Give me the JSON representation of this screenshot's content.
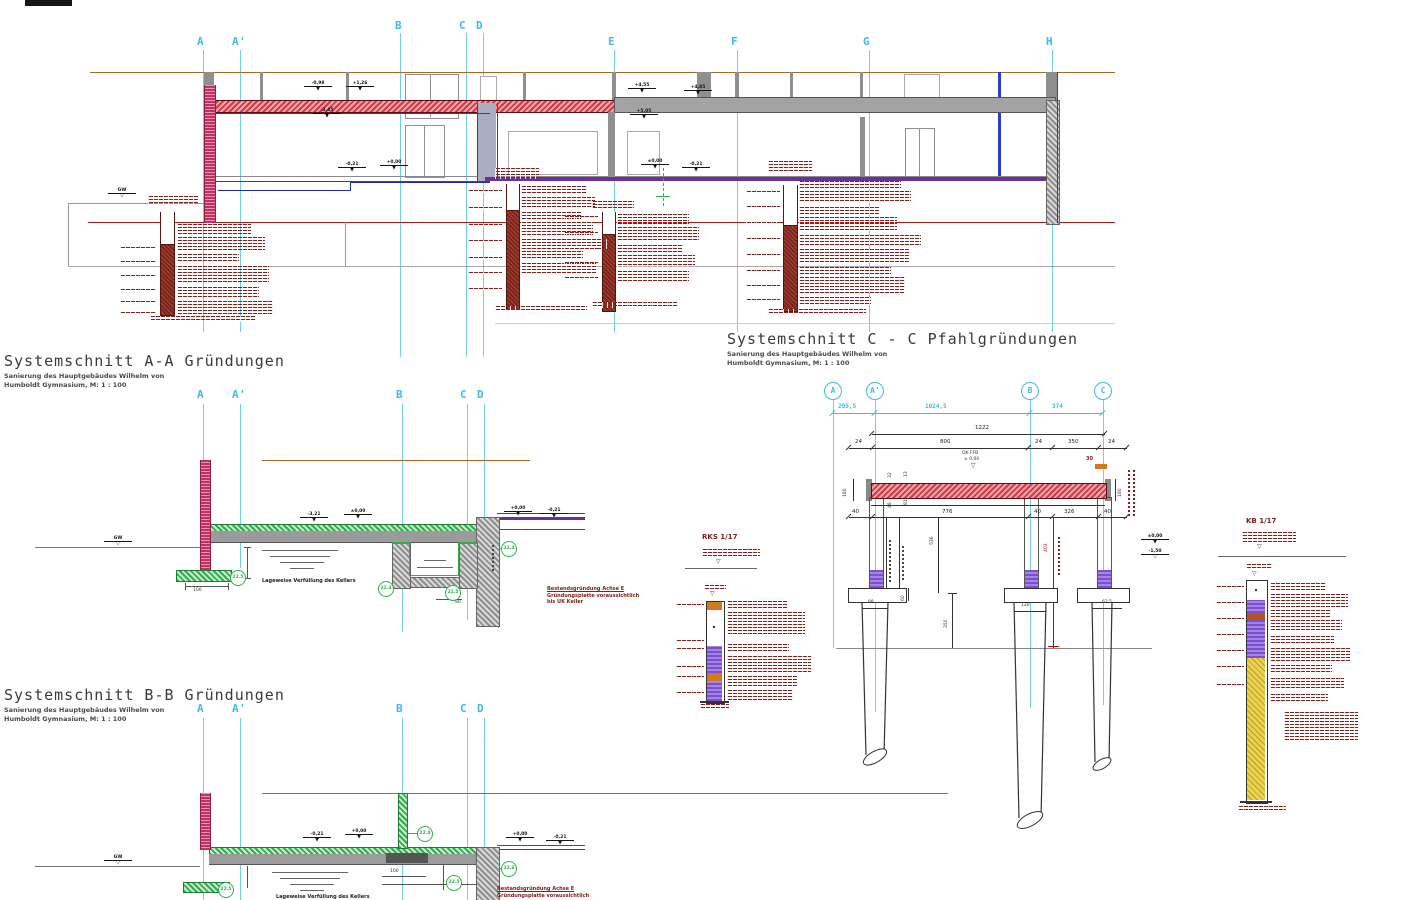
{
  "drawing": {
    "grid_top": [
      "A",
      "A'",
      "B",
      "C",
      "D",
      "E",
      "F",
      "G",
      "H"
    ],
    "grid_section": [
      "A",
      "A'",
      "B",
      "C",
      "D"
    ],
    "pile_axes": [
      "A",
      "A'",
      "B",
      "C"
    ],
    "titles": {
      "a_title": "Systemschnitt A-A Gründungen",
      "b_title": "Systemschnitt B-B Gründungen",
      "c_title": "Systemschnitt C - C Pfahlgründungen",
      "sub1": "Sanierung des Hauptgebäudes Wilhelm von",
      "sub2": "Humboldt Gymnasium, M: 1 : 100"
    },
    "levels_top": [
      "-0,98",
      "+1,26",
      "-3,45",
      "+4,55",
      "+4,85",
      "+5,05",
      "-0,21",
      "+0,00",
      "±0,00",
      "-0,21",
      "GW"
    ],
    "levels_a": [
      "-3,21",
      "±0,00",
      "+0,00",
      "-0,21",
      "GW"
    ],
    "levels_b": [
      "-0,21",
      "+0,00",
      "+0,00",
      "-0,21",
      "GW"
    ],
    "levels_c": [
      "±0,00",
      "-1,50"
    ],
    "ok_ffb": {
      "l1": "OK FFB",
      "l2": "± 0,00"
    },
    "dims": {
      "cyan": [
        "205,5",
        "1024,5",
        "374"
      ],
      "total": "1222",
      "row2": [
        "24",
        "800",
        "24",
        "350",
        "24"
      ],
      "row3": [
        "40",
        "776",
        "40",
        "326",
        "40"
      ],
      "v_180l": "180",
      "v_180r": "180",
      "v_32": "32",
      "v_13": "13",
      "v_48": "48",
      "v_81": "81",
      "v_536": "536",
      "v_403": "403",
      "v_350": "350",
      "v_60": "60",
      "d_30": "30",
      "caps": [
        "88",
        "120",
        "62,5"
      ]
    },
    "circles_a": [
      "22.5",
      "22.4",
      "22.5",
      "22.4"
    ],
    "circles_b": [
      "22.5",
      "22.4",
      "22.5",
      "22.6"
    ],
    "notes": {
      "verfuellung": "Lageweise Verfüllung des Kellers",
      "bestand1": "Bestandsgründung Achse E",
      "bestand2": "Gründungsplatte voraussichtlich",
      "bestand3": "bis UK Keller",
      "dim100": "100",
      "dim80": "80"
    },
    "logs": {
      "rks": "RKS 1/17",
      "kb": "KB 1/17"
    },
    "glyphs": {
      "tri": "▼",
      "tri_open": "▽"
    }
  }
}
